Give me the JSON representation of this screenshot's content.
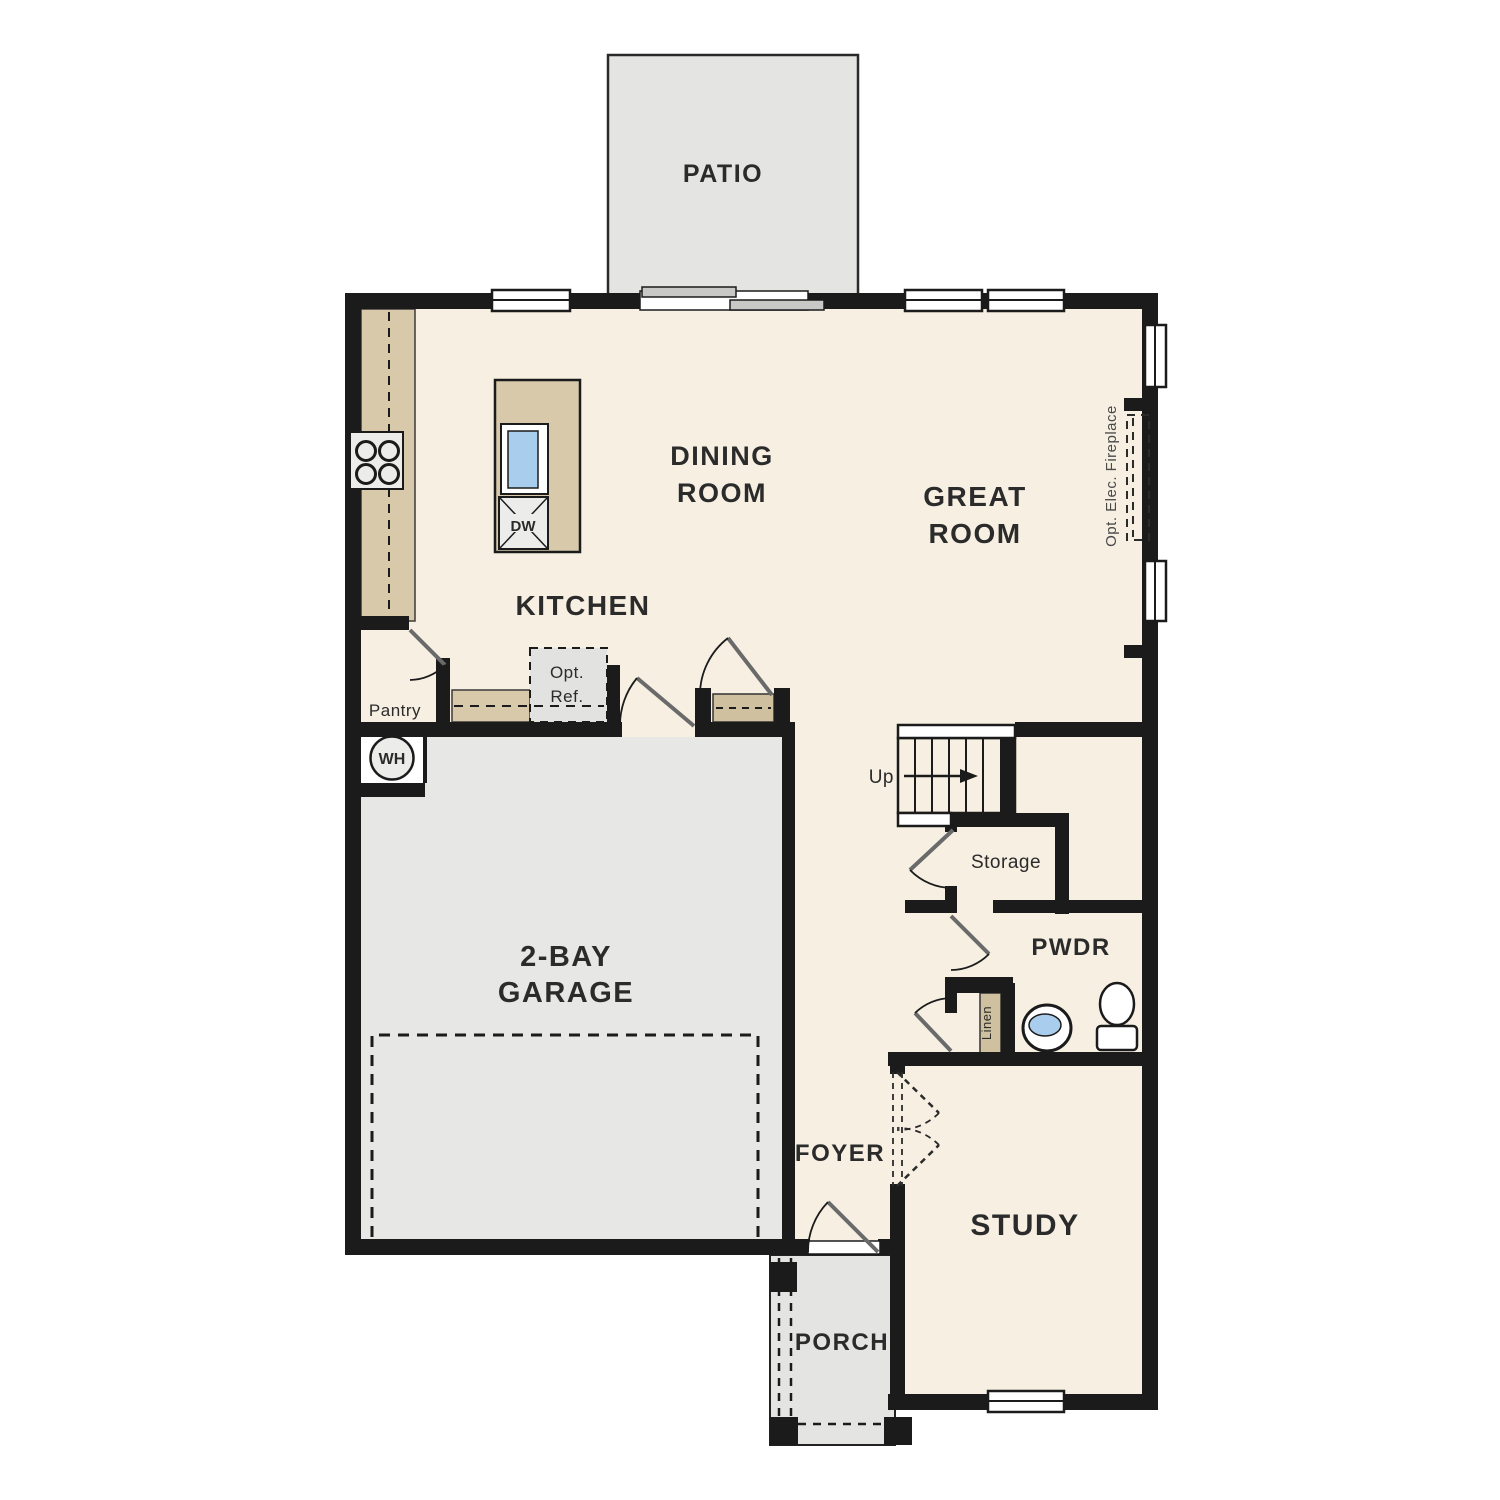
{
  "plan_title": "First floor residential floor plan",
  "labels": {
    "patio": "PATIO",
    "dining_1": "DINING",
    "dining_2": "ROOM",
    "great_1": "GREAT",
    "great_2": "ROOM",
    "kitchen": "KITCHEN",
    "pantry": "Pantry",
    "opt_ref_1": "Opt.",
    "opt_ref_2": "Ref.",
    "dw": "DW",
    "wh": "WH",
    "garage_1": "2-BAY",
    "garage_2": "GARAGE",
    "up": "Up",
    "storage": "Storage",
    "pwdr": "PWDR",
    "linen": "Linen",
    "fireplace": "Opt. Elec. Fireplace",
    "foyer": "FOYER",
    "study": "STUDY",
    "porch": "PORCH"
  },
  "colors": {
    "wall": "#1b1b1b",
    "floor": "#f6efe2",
    "hardscape": "#e4e4e2",
    "garage_floor": "#e7e7e5",
    "counter": "#d8c9ab",
    "closet_shelf": "#cfc0a0",
    "water": "#a9cdec",
    "door_leaf": "#6a6a6a",
    "appliance": "#ececea",
    "opt_ref_fill": "#e2e2e0",
    "slider_panel": "#c8c8c6",
    "text": "#2b2b2b"
  }
}
